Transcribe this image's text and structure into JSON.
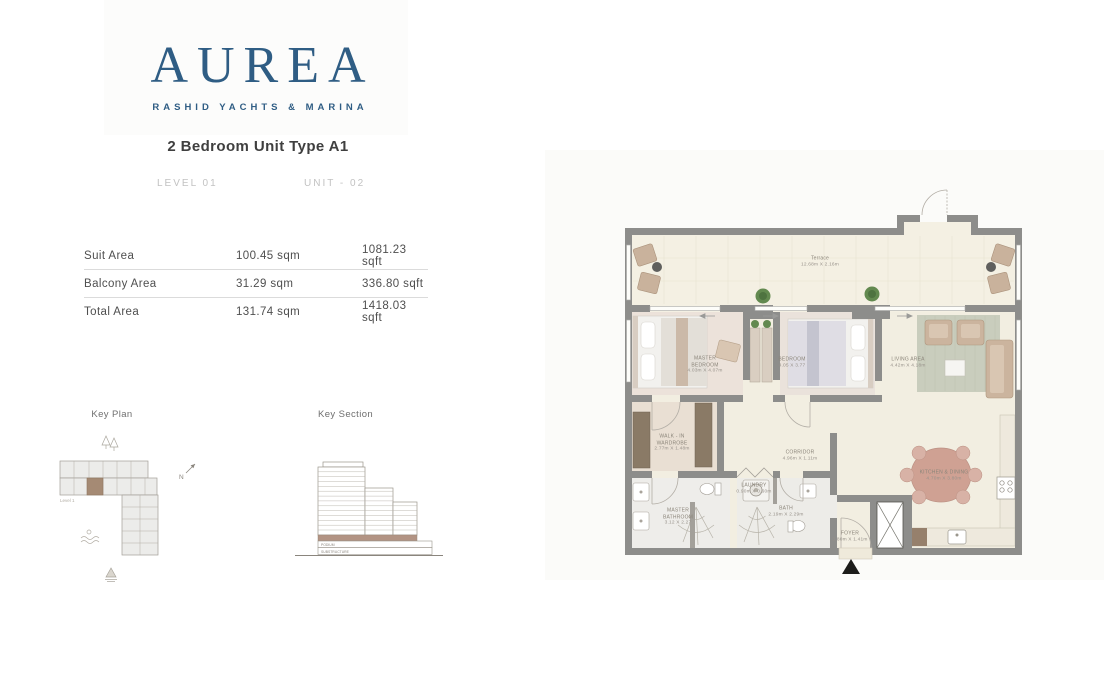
{
  "brand": {
    "logo": "AUREA",
    "tagline": "RASHID YACHTS & MARINA",
    "accent_color": "#2f5d84"
  },
  "header": {
    "title": "2 Bedroom Unit Type A1",
    "level": "LEVEL 01",
    "unit": "UNIT - 02"
  },
  "area_table": {
    "rows": [
      {
        "label": "Suit Area",
        "sqm": "100.45 sqm",
        "sqft": "1081.23 sqft"
      },
      {
        "label": "Balcony Area",
        "sqm": "31.29 sqm",
        "sqft": "336.80 sqft"
      },
      {
        "label": "Total Area",
        "sqm": "131.74 sqm",
        "sqft": "1418.03 sqft"
      }
    ]
  },
  "key_plan": {
    "title": "Key Plan",
    "level_label": "Level 1",
    "north_label": "N",
    "highlight_color": "#a58a74"
  },
  "key_section": {
    "title": "Key Section",
    "podium_label": "PODIUM",
    "substructure_label": "SUBSTRUCTURE",
    "highlight_color": "#b29383"
  },
  "floor_plan": {
    "rooms": [
      {
        "name": "Terrace",
        "dims": "12.68m X 2.16m"
      },
      {
        "name": "MASTER BEDROOM",
        "dims": "4.03m X 4.07m"
      },
      {
        "name": "BEDROOM",
        "dims": "4.05 X 3.77"
      },
      {
        "name": "LIVING AREA",
        "dims": "4.42m X 4.18m"
      },
      {
        "name": "WALK - IN WARDROBE",
        "dims": "2.77m X 1.48m"
      },
      {
        "name": "CORRIDOR",
        "dims": "4.96m X 1.11m"
      },
      {
        "name": "LAUNDRY",
        "dims": "0.90m X 0.60m"
      },
      {
        "name": "MASTER BATHROOM",
        "dims": "3.12 X 2.27"
      },
      {
        "name": "BATH",
        "dims": "2.19m X 2.29m"
      },
      {
        "name": "KITCHEN & DINING",
        "dims": "4.70m X 3.80m"
      },
      {
        "name": "FOYER",
        "dims": "3.80m X 1.41m"
      }
    ],
    "colors": {
      "wall": "#8d8d8b",
      "terrace_floor": "#f4f0e3",
      "bedroom_floor": "#ece2da",
      "rug": "#c9cdbd",
      "furniture": "#cbb49e",
      "plant": "#62894f"
    }
  }
}
